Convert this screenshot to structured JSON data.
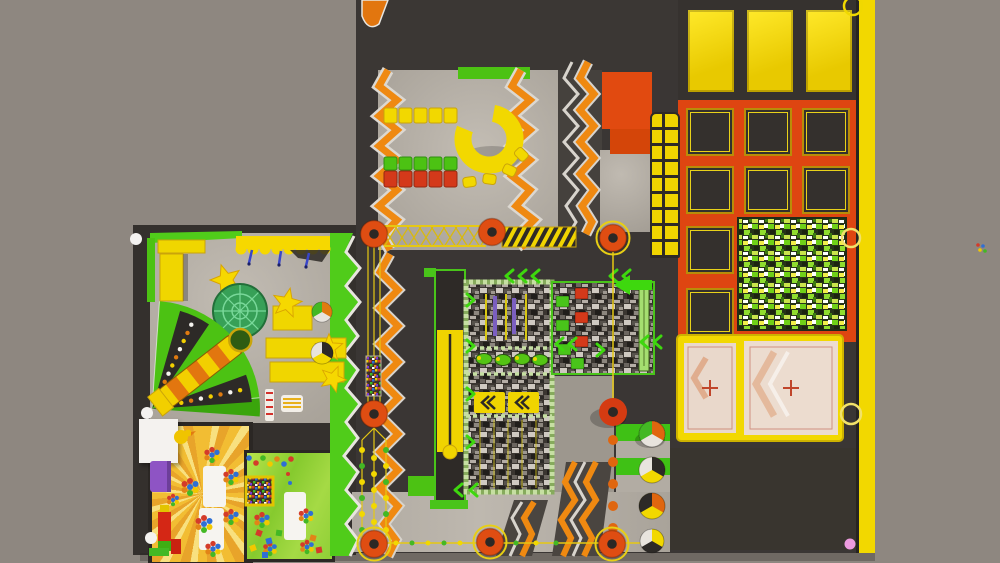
{
  "scene": {
    "name": "indoor-trampoline-park-top-view",
    "canvas_w": 1000,
    "canvas_h": 563
  },
  "palette": {
    "bg": "#8e8780",
    "dark": "#3a3634",
    "dark2": "#2e2a27",
    "floor": "#b7b1a8",
    "orange": "#ef8911",
    "orangedeep": "#e2760f",
    "redorange": "#de4511",
    "pole": "#df4d12",
    "yellow": "#f2d800",
    "yellowdeep": "#caa40a",
    "gold": "#e6c813",
    "green": "#4cc213",
    "greenbright": "#3ed80e",
    "greenpale": "#c6dfa2",
    "limewall": "#50cc1a",
    "dome": "#2f9e52",
    "beige": "#e9d8cb",
    "white": "#f2f0ec",
    "purple": "#8e54c4",
    "blue": "#3946c9",
    "pink": "#ec9ade",
    "red": "#d43b2a",
    "blue2": "#2f6fd4"
  },
  "zones": {
    "facility": {
      "label": "trampoline park hall"
    },
    "topblock": {
      "label": "roofed service block"
    },
    "hall": {
      "label": "soft-play hall with zigzag walls"
    },
    "ring": {
      "label": "yellow C-ring play unit"
    },
    "panels": {
      "label": "yellow wall panels"
    },
    "grid": {
      "label": "trampoline grid court"
    },
    "minilane": {
      "label": "mini trampoline lane"
    },
    "camowall": {
      "label": "camouflage climbing wall pit"
    },
    "mats": {
      "label": "airbag landing mats"
    },
    "lanes": {
      "label": "wrecking-ball trampoline lanes"
    },
    "storage": {
      "label": "back-of-house room"
    },
    "wall": {
      "label": "yellow perimeter wall"
    },
    "ninja": {
      "label": "ninja foam-block pits"
    },
    "beam": {
      "label": "battle-beam lane"
    },
    "stones": {
      "label": "stepping-stone pit"
    },
    "zipline": {
      "label": "zipline run with target"
    },
    "bridge": {
      "label": "rope net bridge"
    },
    "kids": {
      "label": "kids soft-play area"
    },
    "fan": {
      "label": "carousel slide fan"
    },
    "domezone": {
      "label": "net dome trampoline"
    },
    "sunroom": {
      "label": "sunburst ball-pit room"
    },
    "greenroom": {
      "label": "toddler green room"
    },
    "desk": {
      "label": "reception desk"
    },
    "columns": {
      "label": "support columns"
    }
  },
  "counts": {
    "trampoline_squares": 8,
    "yellow_wall_panels": 3,
    "mini_lane_cells": 16,
    "stars": 4,
    "wrecking_balls": 4,
    "floor_poles": 7,
    "wall_rings": 3,
    "landing_mats": 2
  },
  "ball_colors": [
    [
      "#e8e4de",
      "#e0660f",
      "#43b824"
    ],
    [
      "#f2d800",
      "#2d2a27",
      "#e8e4de"
    ],
    [
      "#f2d800",
      "#e0660f",
      "#2d2a27"
    ],
    [
      "#2d2a27",
      "#f2d800",
      "#e8e4de"
    ]
  ]
}
